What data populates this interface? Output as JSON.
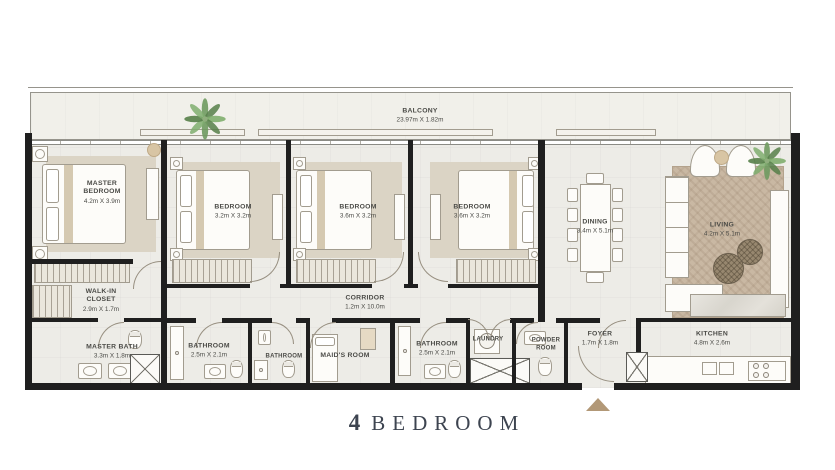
{
  "title": {
    "number": "4",
    "text": "BEDROOM"
  },
  "rooms": {
    "balcony": {
      "name": "BALCONY",
      "dims": "23.97m X 1.82m"
    },
    "master_bedroom": {
      "name": "MASTER BEDROOM",
      "dims": "4.2m X 3.9m"
    },
    "bedroom_2": {
      "name": "BEDROOM",
      "dims": "3.2m X 3.2m"
    },
    "bedroom_3": {
      "name": "BEDROOM",
      "dims": "3.6m X 3.2m"
    },
    "bedroom_4": {
      "name": "BEDROOM",
      "dims": "3.6m X 3.2m"
    },
    "dining": {
      "name": "DINING",
      "dims": "3.4m X 5.1m"
    },
    "living": {
      "name": "LIVING",
      "dims": "4.2m X 5.1m"
    },
    "walk_in_closet": {
      "name": "WALK-IN CLOSET",
      "dims": "2.9m X 1.7m"
    },
    "master_bath": {
      "name": "MASTER BATH",
      "dims": "3.3m X 1.8m"
    },
    "bathroom_1": {
      "name": "BATHROOM",
      "dims": "2.5m X 2.1m"
    },
    "corridor": {
      "name": "CORRIDOR",
      "dims": "1.2m X 10.0m"
    },
    "bathroom_2": {
      "name": "BATHROOM"
    },
    "maids_room": {
      "name": "MAID'S ROOM"
    },
    "bathroom_3": {
      "name": "BATHROOM",
      "dims": "2.5m X 2.1m"
    },
    "laundry": {
      "name": "LAUNDRY"
    },
    "powder_room": {
      "name": "POWDER ROOM"
    },
    "foyer": {
      "name": "FOYER",
      "dims": "1.7m X 1.8m"
    },
    "kitchen": {
      "name": "KITCHEN",
      "dims": "4.8m X 2.6m"
    }
  },
  "icons": {
    "palm_plant": "palm-plant",
    "entrance_arrow": "entrance-arrow"
  },
  "palette": {
    "floor": "#edece7",
    "balcony_floor": "#f1f0ea",
    "wall": "#1f1f1f",
    "carpet": "#dbd4c5",
    "rug": "#c9b8a3",
    "plant_green": "#6f9a60",
    "label_text": "#4b4b47",
    "title_text": "#3d4450",
    "arrow_tan": "#b29877"
  }
}
